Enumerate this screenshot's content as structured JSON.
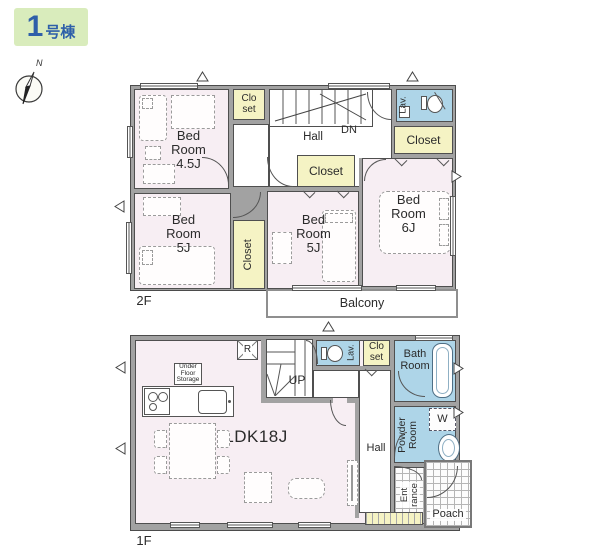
{
  "badge": {
    "number": "1",
    "suffix": "号棟"
  },
  "compass": {
    "north": "N"
  },
  "colors": {
    "badge_bg": "#d9ecbc",
    "badge_text": "#2e5fa9",
    "room_pink": "#f7eef3",
    "closet_yellow": "#f5f3c4",
    "wet_blue": "#aed5e8",
    "wall_gray": "#a2a2a2"
  },
  "floor2": {
    "label": "2F",
    "bedroom45": {
      "l1": "Bed",
      "l2": "Room",
      "l3": "4.5J"
    },
    "closet_small": {
      "l1": "Clo",
      "l2": "set"
    },
    "hall": "Hall",
    "down": "DN",
    "lav": "Lav.",
    "closet_right": "Closet",
    "closet_mid": "Closet",
    "closet_vertical": "Closet",
    "bedroom5_left": {
      "l1": "Bed",
      "l2": "Room",
      "l3": "5J"
    },
    "bedroom5_mid": {
      "l1": "Bed",
      "l2": "Room",
      "l3": "5J"
    },
    "bedroom6": {
      "l1": "Bed",
      "l2": "Room",
      "l3": "6J"
    },
    "balcony": "Balcony"
  },
  "floor1": {
    "label": "1F",
    "ldk": "LDK18J",
    "up": "UP",
    "lav": "Lav.",
    "closet": {
      "l1": "Clo",
      "l2": "set"
    },
    "bath": {
      "l1": "Bath",
      "l2": "Room"
    },
    "powder": {
      "l1": "Powder",
      "l2": "Room"
    },
    "washer": "W",
    "fridge": "R",
    "hall": "Hall",
    "entrance": {
      "l1": "Ent",
      "l2": "rance"
    },
    "porch": "Poach",
    "underfloor": {
      "l1": "Under",
      "l2": "Floor",
      "l3": "Storage"
    }
  }
}
